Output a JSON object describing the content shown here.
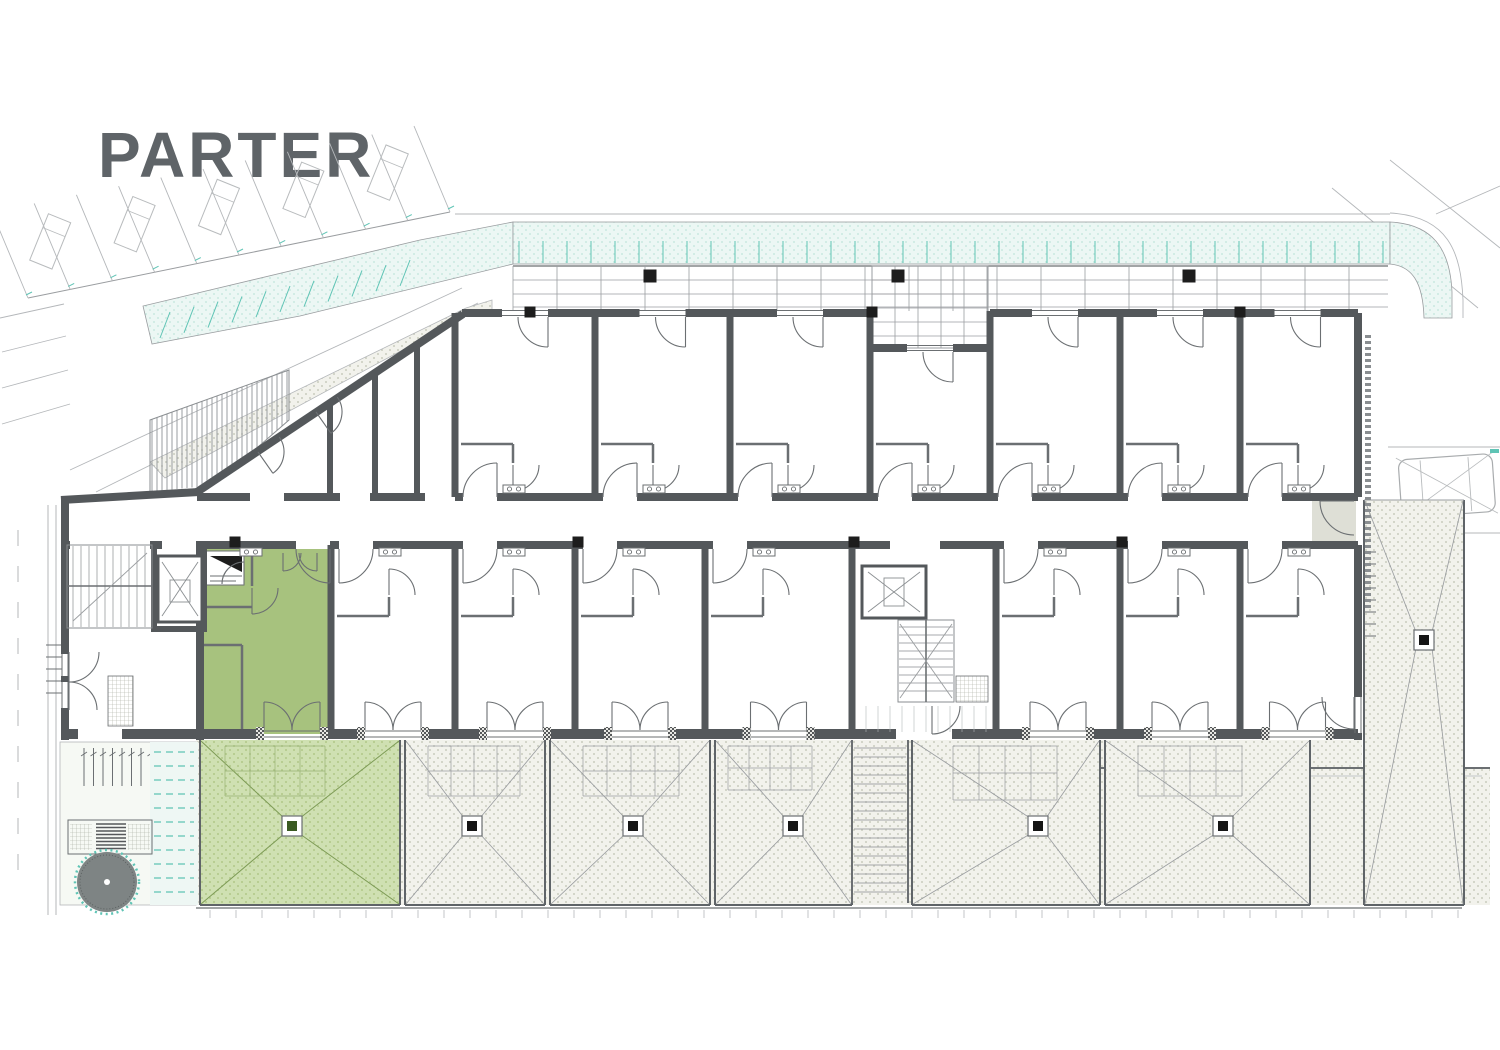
{
  "title": "PARTER",
  "colors": {
    "wall": "#54585b",
    "thin": "#6b6f72",
    "faint": "#b4b7ba",
    "grid": "#9a9da0",
    "lightline": "#8a8e91",
    "greenUnit": "#a7c27e",
    "greenEdge": "#7d9b55",
    "teal": "#5fc4b5",
    "black": "#1d1d1d",
    "title": "#5f6468",
    "pale": "#dedfd6",
    "drainGreen": "#3a5a22"
  },
  "geom": {
    "roads": [
      [
        70,
        470,
        462,
        288
      ],
      [
        96,
        492,
        478,
        303
      ],
      [
        0,
        318,
        64,
        304
      ],
      [
        2,
        352,
        66,
        336
      ],
      [
        2,
        388,
        68,
        370
      ],
      [
        2,
        424,
        70,
        404
      ],
      [
        1332,
        188,
        1478,
        308
      ],
      [
        1390,
        160,
        1500,
        248
      ],
      [
        1436,
        214,
        1500,
        186
      ],
      [
        1388,
        447,
        1500,
        447
      ],
      [
        1388,
        533,
        1500,
        533
      ],
      [
        455,
        214,
        1390,
        214
      ]
    ],
    "street": {
      "edges": [
        [
          48,
          505,
          48,
          915
        ],
        [
          56,
          505,
          56,
          915
        ]
      ],
      "dashX": 18,
      "dashY0": 530,
      "dashStep": 36,
      "dashN": 10,
      "dashLen": 16
    },
    "parking": {
      "base": [
        28,
        298,
        450,
        212
      ],
      "n": 11,
      "div": [
        -36,
        -86
      ],
      "cars": [
        1,
        3,
        5,
        7,
        9
      ]
    },
    "car": {
      "x": 1398,
      "y": 460,
      "w": 94,
      "h": 58,
      "rot": -4
    },
    "band": {
      "rect": [
        513,
        222,
        877,
        42
      ],
      "corner": "M1390,222 C1432,224 1450,248 1452,292 L1452,318 L1424,318 C1423,282 1412,266 1390,264 Z",
      "outer": "M1390,213 C1448,216 1461,252 1463,300 L1463,318",
      "wedge": "513,222 513,264 300,316 152,344 143,306 420,240",
      "ticks": {
        "x0": 519,
        "x1": 1386,
        "step": 24,
        "y0": 241,
        "y1": 263
      },
      "wedgeTicks": {
        "n": 11,
        "x0": 160,
        "y0": 338,
        "dx": 24,
        "dy": -5.2,
        "lx": 10,
        "ly": -26
      }
    },
    "walkway": "150,462 466,308 492,300 492,316 462,318 165,478",
    "ramp": "150,420 289,370 289,420 206,492 150,492",
    "tband": {
      "x0": 513,
      "x1": 1388,
      "y0": 266,
      "y1": 311,
      "vstep": 44,
      "hys": [
        280,
        294,
        307
      ]
    },
    "recessGrid": {
      "x": 872,
      "y": 266,
      "w": 116,
      "h": 82,
      "vstep": 23,
      "hstep": 14
    },
    "bandCols": [
      [
        650,
        276
      ],
      [
        898,
        276
      ],
      [
        1189,
        276
      ]
    ],
    "footprint": "65,500 197,487 462,313 1358,313 1358,740 65,740",
    "topWallY": 313,
    "recessWallY": 348,
    "recessIdx": 3,
    "corridor": {
      "x0": 65,
      "x1": 1358,
      "yT": 497,
      "yB": 545
    },
    "upperUnits": [
      [
        455,
        595
      ],
      [
        595,
        730
      ],
      [
        730,
        870
      ],
      [
        870,
        990
      ],
      [
        990,
        1120
      ],
      [
        1120,
        1240
      ],
      [
        1240,
        1355
      ]
    ],
    "lowerUnits": [
      [
        331,
        455
      ],
      [
        455,
        575
      ],
      [
        575,
        705
      ],
      [
        705,
        852
      ],
      [
        996,
        1120
      ],
      [
        1120,
        1240
      ],
      [
        1240,
        1355
      ]
    ],
    "corrTopExtraGaps": [
      [
        250,
        284
      ],
      [
        340,
        370
      ],
      [
        425,
        455
      ]
    ],
    "corrBotExtraGaps": [
      [
        70,
        150
      ],
      [
        162,
        196
      ],
      [
        296,
        330
      ],
      [
        890,
        940
      ]
    ],
    "bottomExtraGaps": [
      [
        78,
        122
      ],
      [
        264,
        320
      ],
      [
        896,
        952
      ]
    ],
    "extraWalls": [
      [
        65,
        500,
        65,
        654,
        8
      ],
      [
        65,
        676,
        65,
        682,
        8
      ],
      [
        65,
        708,
        65,
        740,
        8
      ],
      [
        61,
        500,
        199,
        492,
        8
      ],
      [
        197,
        492,
        463,
        314,
        8
      ],
      [
        330,
        404,
        330,
        497,
        6
      ],
      [
        375,
        375,
        375,
        497,
        6
      ],
      [
        417,
        347,
        417,
        497,
        6
      ],
      [
        1358,
        313,
        1358,
        497,
        8
      ],
      [
        1358,
        545,
        1358,
        697,
        8
      ],
      [
        1358,
        733,
        1358,
        740,
        8
      ],
      [
        200,
        545,
        200,
        740,
        8
      ],
      [
        154,
        545,
        154,
        632,
        6
      ],
      [
        204,
        545,
        204,
        632,
        6
      ],
      [
        154,
        629,
        204,
        629,
        6
      ],
      [
        870,
        311,
        870,
        352,
        7
      ],
      [
        990,
        311,
        990,
        352,
        7
      ],
      [
        852,
        545,
        852,
        734,
        7
      ]
    ],
    "extraSills": [
      [
        62,
        654,
        62,
        676
      ],
      [
        68,
        654,
        68,
        676
      ],
      [
        62,
        682,
        62,
        708
      ],
      [
        68,
        682,
        68,
        708
      ],
      [
        1355,
        697,
        1355,
        733
      ],
      [
        1361,
        697,
        1361,
        733
      ]
    ],
    "extraArcs": [
      [
        258,
        452,
        26,
        -35,
        55
      ],
      [
        316,
        412,
        26,
        -35,
        55
      ],
      [
        69,
        652,
        30,
        0,
        90
      ],
      [
        69,
        710,
        28,
        0,
        -90
      ],
      [
        1354,
        501,
        34,
        90,
        180
      ],
      [
        1354,
        697,
        32,
        180,
        90
      ],
      [
        932,
        706,
        28,
        0,
        90
      ],
      [
        244,
        584,
        22,
        180,
        270
      ],
      [
        252,
        588,
        26,
        0,
        90
      ],
      [
        283,
        553,
        18,
        0,
        90
      ],
      [
        317,
        553,
        18,
        180,
        90
      ]
    ],
    "green": {
      "rect": [
        204,
        549,
        127,
        185
      ],
      "closet": [
        206,
        551,
        38,
        34
      ],
      "c": 292,
      "hinge": 330,
      "parts": [
        [
          204,
          607,
          252,
          607
        ],
        [
          252,
          549,
          252,
          586
        ],
        [
          242,
          645,
          242,
          734
        ],
        [
          204,
          645,
          242,
          645
        ]
      ],
      "vent": [
        240,
        548
      ]
    },
    "sign": {
      "tri": "210,556 242,556 242,572",
      "lines": [
        [
          210,
          576,
          242,
          576
        ],
        [
          210,
          581,
          236,
          581
        ]
      ]
    },
    "terraces": {
      "base": [
        196,
        740,
        1166,
        165
      ],
      "cells": [
        [
          200,
          400,
          292
        ],
        [
          405,
          545,
          472
        ],
        [
          550,
          710,
          633
        ],
        [
          715,
          852,
          793
        ],
        [
          912,
          1100,
          1038
        ],
        [
          1105,
          1310,
          1223
        ]
      ],
      "green": 0,
      "stairs": [
        852,
        908
      ],
      "furn": [
        [
          225,
          746,
          100,
          50
        ],
        [
          428,
          746,
          92,
          50
        ],
        [
          583,
          746,
          96,
          50
        ],
        [
          728,
          746,
          84,
          44
        ],
        [
          953,
          746,
          104,
          54
        ],
        [
          1138,
          746,
          104,
          50
        ]
      ]
    },
    "rightTerrace": {
      "rect": [
        1364,
        500,
        100,
        405
      ],
      "drain": [
        1424,
        640
      ],
      "ladderY0": 552,
      "ladderN": 8,
      "ladderStep": 12
    },
    "extension": {
      "outer": "M1098,905 L1098,768 L1490,768",
      "inner": "M1106,897 L1106,776 L1482,776",
      "rect": [
        1098,
        768,
        392,
        137
      ]
    },
    "edge": [
      196,
      908,
      1462,
      908
    ],
    "ticksRow": {
      "y": 910,
      "x0": 210,
      "x1": 1460,
      "step": 26,
      "len": 8
    },
    "garden": {
      "bg": [
        60,
        742,
        136,
        163
      ],
      "bikes": {
        "x0": 84,
        "y": 748,
        "n": 8,
        "step": 9.5,
        "len": 38
      },
      "path": [
        150,
        742,
        48,
        163
      ],
      "pathDash": {
        "y0": 752,
        "y1": 898,
        "step": 14,
        "x0": 154,
        "x1": 194
      },
      "bench": [
        68,
        820,
        84,
        34
      ],
      "benchInner": [
        96,
        822,
        30,
        30
      ],
      "tree": {
        "cx": 107,
        "cy": 882,
        "r": 30
      }
    },
    "hatchTicks": [
      [
        46,
        645
      ],
      [
        46,
        657
      ],
      [
        46,
        669
      ],
      [
        46,
        681
      ],
      [
        46,
        693
      ]
    ],
    "columns": [
      [
        235,
        542
      ],
      [
        578,
        542
      ],
      [
        854,
        542
      ],
      [
        1122,
        542
      ],
      [
        530,
        312
      ],
      [
        872,
        312
      ],
      [
        1240,
        312
      ]
    ],
    "cores": {
      "leftStairs": [
        67,
        545,
        85,
        83
      ],
      "leftElev": [
        158,
        556,
        44,
        66
      ],
      "midElev": [
        862,
        566,
        64,
        52
      ],
      "midStairs": [
        898,
        620,
        56,
        82
      ],
      "matR": [
        956,
        676,
        32,
        26
      ],
      "matL": [
        108,
        676,
        25,
        50
      ],
      "landing": [
        860,
        704,
        128,
        30
      ],
      "extStairs": [
        852,
        740,
        908,
        903
      ]
    },
    "vestibule": [
      1312,
      501,
      44,
      40
    ],
    "dashedStrip": [
      1368,
      335,
      1368,
      610
    ]
  }
}
